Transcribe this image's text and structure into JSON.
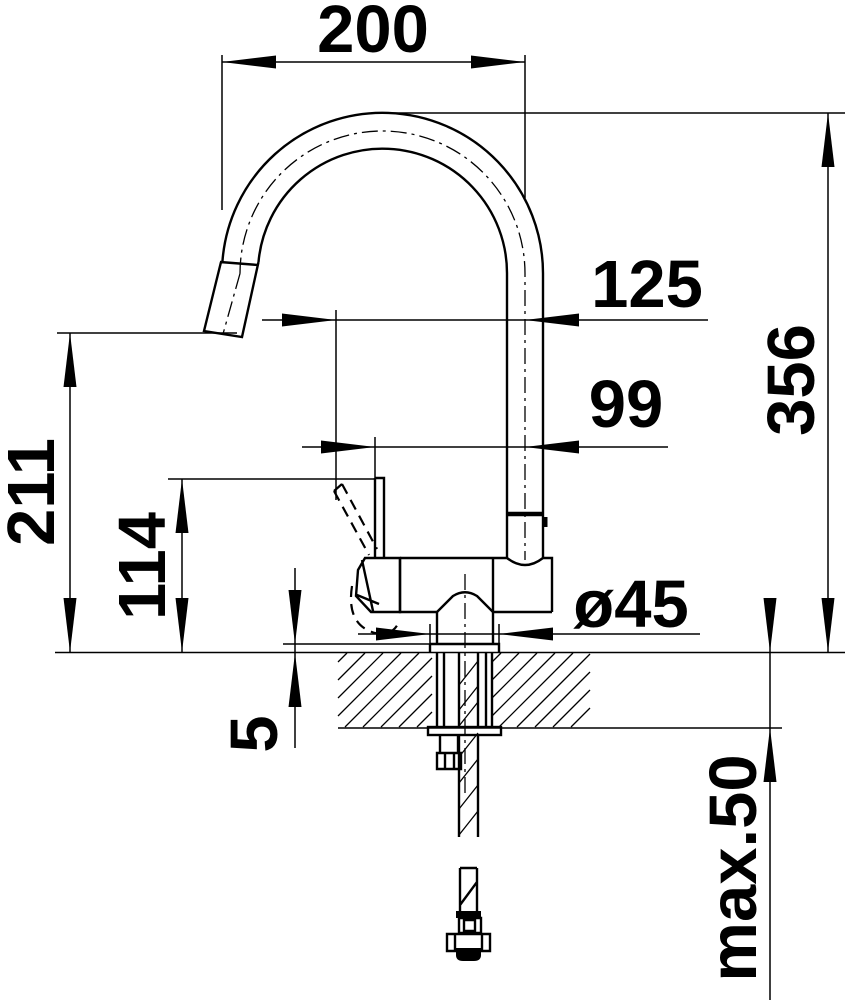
{
  "page": {
    "type": "technical-dimension-drawing",
    "subject": "kitchen faucet side elevation with installation cross-section",
    "background": "#ffffff"
  },
  "colors": {
    "line": "#000000",
    "text": "#000000"
  },
  "labels": {
    "spout_width": "200",
    "lever_forward_reach": "125",
    "lever_upright_reach": "99",
    "overall_height": "356",
    "spout_outlet_height": "211",
    "lever_top_height": "114",
    "base_diameter": "ø45",
    "base_plate_height": "5",
    "max_deck_thickness": "max.50"
  }
}
